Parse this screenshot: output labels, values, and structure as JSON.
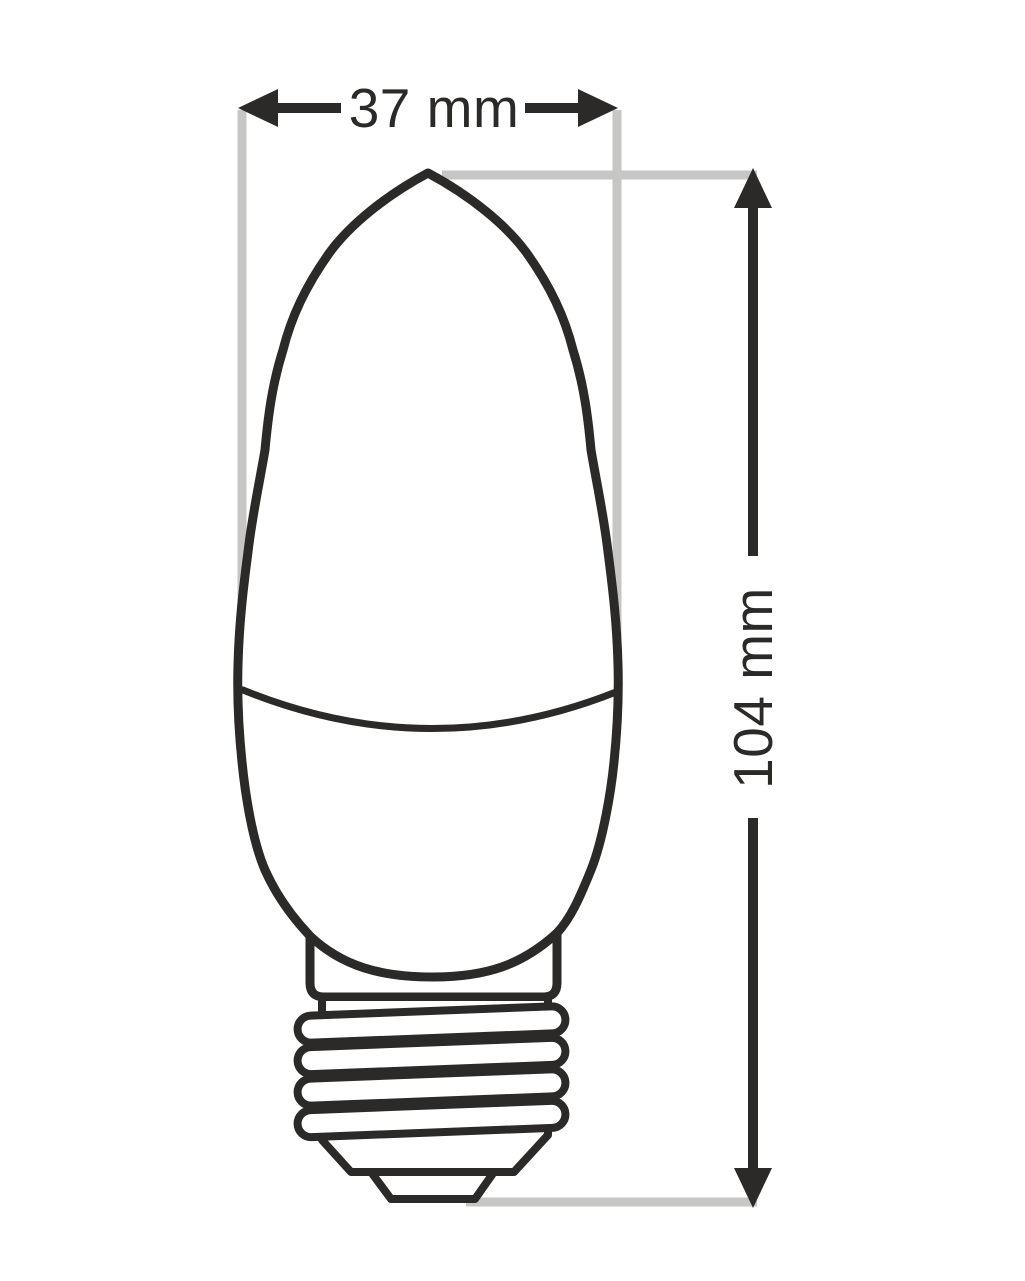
{
  "diagram": {
    "kind": "technical-dimension-drawing",
    "subject": "candle-shaped light bulb with screw base",
    "width_label": "37 mm",
    "height_label": "104 mm",
    "colors": {
      "outline": "#2b2a29",
      "extension": "#c6c6c5",
      "background": "#ffffff",
      "fill": "#ffffff"
    }
  }
}
